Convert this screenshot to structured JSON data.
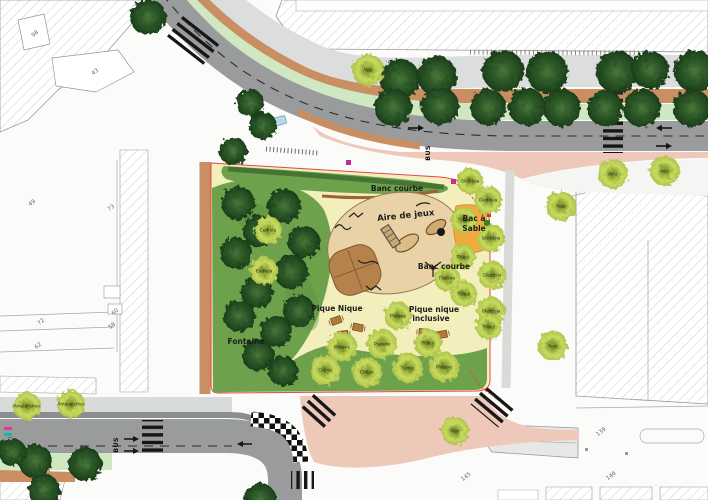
{
  "legend_labels": {
    "banc_courbe_top": "Banc courbe",
    "aire_de_jeux": "Aire de jeux",
    "bac_a_sable_1": "Bac à",
    "bac_a_sable_2": "Sable",
    "banc_courbe_right": "Banc courbe",
    "pique_nique": "Pique Nique",
    "pique_nique_inclusive_1": "Pique nique",
    "pique_nique_inclusive_2": "inclusive",
    "fontaine": "Fontaine",
    "bus_top": "BUS",
    "bus_bottom": "BUS"
  },
  "parcel_numbers": [
    {
      "value": "98",
      "x": 36,
      "y": 35,
      "rot": -38
    },
    {
      "value": "43",
      "x": 96,
      "y": 73,
      "rot": -38
    },
    {
      "value": "49",
      "x": 33,
      "y": 204,
      "rot": -38
    },
    {
      "value": "73",
      "x": 112,
      "y": 209,
      "rot": -38
    },
    {
      "value": "60",
      "x": 116,
      "y": 313,
      "rot": -38
    },
    {
      "value": "58",
      "x": 113,
      "y": 327,
      "rot": -38
    },
    {
      "value": "72",
      "x": 42,
      "y": 323,
      "rot": -38
    },
    {
      "value": "62",
      "x": 39,
      "y": 347,
      "rot": -38
    },
    {
      "value": "139",
      "x": 602,
      "y": 433,
      "rot": -38
    },
    {
      "value": "146",
      "x": 612,
      "y": 477,
      "rot": -38
    },
    {
      "value": "145",
      "x": 467,
      "y": 478,
      "rot": -38
    }
  ],
  "trees": {
    "dark": [
      [
        400,
        79,
        20
      ],
      [
        437,
        76,
        20
      ],
      [
        503,
        71,
        21
      ],
      [
        547,
        72,
        21
      ],
      [
        617,
        72,
        21
      ],
      [
        650,
        70,
        19
      ],
      [
        695,
        71,
        21
      ],
      [
        393,
        107,
        19
      ],
      [
        440,
        106,
        19
      ],
      [
        488,
        107,
        18
      ],
      [
        527,
        107,
        19
      ],
      [
        562,
        108,
        19
      ],
      [
        605,
        108,
        18
      ],
      [
        642,
        108,
        19
      ],
      [
        692,
        108,
        19
      ],
      [
        148,
        17,
        18
      ],
      [
        250,
        103,
        14
      ],
      [
        263,
        126,
        14
      ],
      [
        233,
        151,
        14
      ],
      [
        238,
        203,
        17
      ],
      [
        284,
        206,
        17
      ],
      [
        259,
        231,
        16
      ],
      [
        304,
        242,
        16
      ],
      [
        236,
        253,
        16
      ],
      [
        291,
        272,
        17
      ],
      [
        257,
        292,
        16
      ],
      [
        299,
        311,
        16
      ],
      [
        239,
        316,
        16
      ],
      [
        276,
        331,
        16
      ],
      [
        258,
        355,
        16
      ],
      [
        283,
        371,
        15
      ],
      [
        35,
        461,
        17
      ],
      [
        85,
        464,
        17
      ],
      [
        12,
        452,
        14
      ],
      [
        44,
        490,
        16
      ],
      [
        260,
        499,
        16
      ]
    ],
    "light": [
      {
        "x": 368,
        "y": 70,
        "r": 16,
        "label": "Acer"
      },
      {
        "x": 613,
        "y": 174,
        "r": 15,
        "label": "Acer"
      },
      {
        "x": 665,
        "y": 171,
        "r": 15,
        "label": "Acer"
      },
      {
        "x": 561,
        "y": 206,
        "r": 15,
        "label": "Acer"
      },
      {
        "x": 553,
        "y": 346,
        "r": 15,
        "label": "Acer"
      },
      {
        "x": 455,
        "y": 431,
        "r": 14,
        "label": "Acer"
      },
      {
        "x": 27,
        "y": 406,
        "r": 14,
        "label": "Amelanchier"
      },
      {
        "x": 71,
        "y": 404,
        "r": 14,
        "label": "Amelanchier"
      },
      {
        "x": 268,
        "y": 230,
        "r": 14,
        "label": "Cedrela"
      },
      {
        "x": 264,
        "y": 271,
        "r": 14,
        "label": "Cedrela"
      },
      {
        "x": 470,
        "y": 181,
        "r": 13,
        "label": "Gleditsia"
      },
      {
        "x": 488,
        "y": 200,
        "r": 14,
        "label": "Gleditsia"
      },
      {
        "x": 464,
        "y": 220,
        "r": 13,
        "label": "Tilleul"
      },
      {
        "x": 491,
        "y": 238,
        "r": 14,
        "label": "Gleditsia"
      },
      {
        "x": 463,
        "y": 257,
        "r": 13,
        "label": "Tilleul"
      },
      {
        "x": 492,
        "y": 275,
        "r": 14,
        "label": "Gleditsia"
      },
      {
        "x": 464,
        "y": 294,
        "r": 13,
        "label": "Tilleul"
      },
      {
        "x": 491,
        "y": 311,
        "r": 14,
        "label": "Gleditsia"
      },
      {
        "x": 489,
        "y": 327,
        "r": 13,
        "label": "Tilleul"
      },
      {
        "x": 447,
        "y": 278,
        "r": 13,
        "label": "Platane"
      },
      {
        "x": 398,
        "y": 316,
        "r": 14,
        "label": "Platane"
      },
      {
        "x": 428,
        "y": 343,
        "r": 14,
        "label": "Tilleul"
      },
      {
        "x": 342,
        "y": 347,
        "r": 15,
        "label": "Platane"
      },
      {
        "x": 382,
        "y": 344,
        "r": 15,
        "label": "Platane"
      },
      {
        "x": 325,
        "y": 370,
        "r": 15,
        "label": "Chêne"
      },
      {
        "x": 367,
        "y": 372,
        "r": 15,
        "label": "Chêne"
      },
      {
        "x": 408,
        "y": 368,
        "r": 15,
        "label": "Ginko"
      },
      {
        "x": 444,
        "y": 367,
        "r": 15,
        "label": "Platane"
      }
    ]
  },
  "colors": {
    "road_gray": "#999b9d",
    "sidewalk_gray": "#dcdedd",
    "pink_pedestrian": "#eec9ba",
    "planting_brown": "#c98f63",
    "cycle_green": "#cfe8c2",
    "lawn_green": "#6da14b",
    "square_floor": "#f2efbd",
    "playground_tan": "#e9d3a6",
    "mound_brown": "#b5824c",
    "sandbox_orange": "#f2a93e",
    "tree_dark": "#2f5a29",
    "tree_light": "#c8dc60",
    "red_outline": "#e04848",
    "magenta_marker": "#c32b96",
    "water_blue": "#2e82b8"
  }
}
